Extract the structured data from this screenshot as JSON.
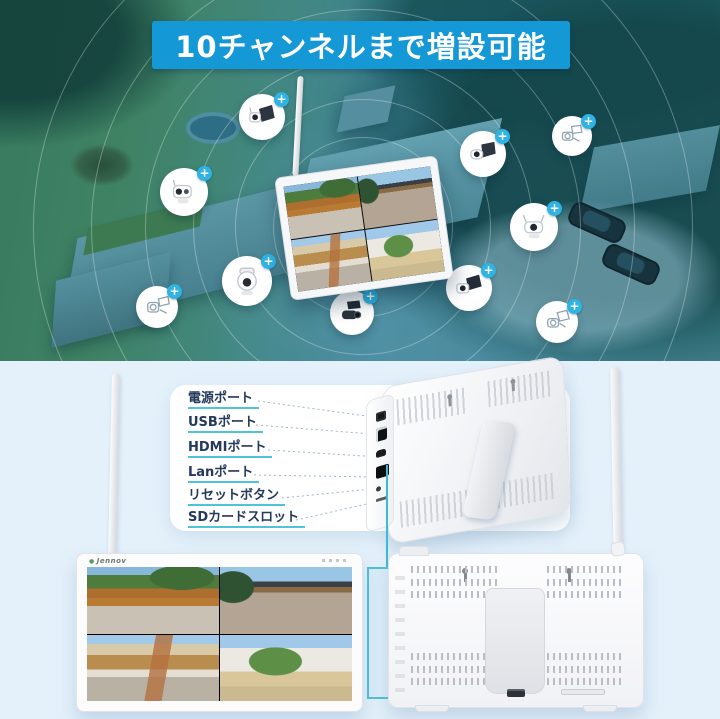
{
  "banner": {
    "text": "10チャンネルまで増設可能",
    "bg_color": "#1598d6",
    "text_color": "#ffffff"
  },
  "brand": {
    "logo": "Jennov"
  },
  "port_labels": [
    "電源ポート",
    "USBポート",
    "HDMIポート",
    "Lanポート",
    "リセットボタン",
    "SDカードスロット"
  ],
  "scene": {
    "camera_badge_count": 10,
    "plus_icon": "+",
    "expandable_channels_shown_in_title": 10
  },
  "colors": {
    "banner_blue": "#1598d6",
    "accent_cyan_underline": "#4ec3d9",
    "callout_cyan": "#3fb9cf",
    "plus_badge_cyan": "#2eb3e3",
    "bottom_background": "#e4f1fb",
    "label_text": "#24395c"
  }
}
